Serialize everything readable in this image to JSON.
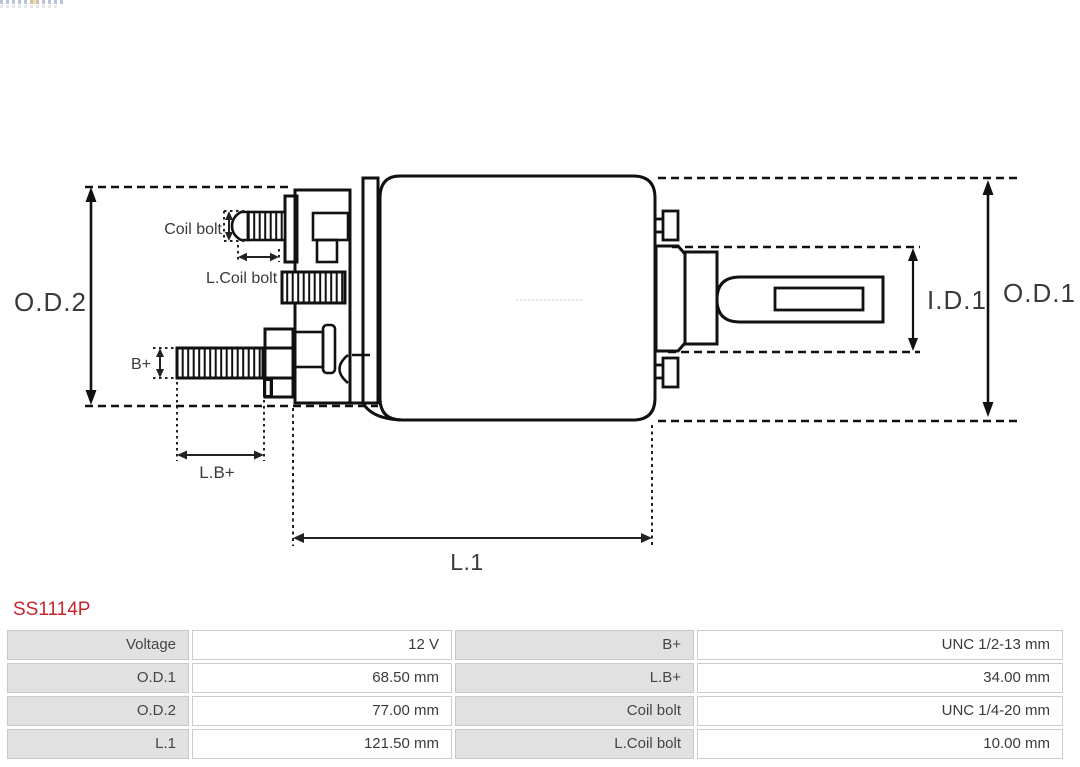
{
  "part_number": "SS1114P",
  "diagram": {
    "labels": {
      "od2": "O.D.2",
      "coil_bolt": "Coil bolt",
      "l_coil_bolt": "L.Coil bolt",
      "b_plus": "B+",
      "l_b_plus": "L.B+",
      "l1": "L.1",
      "id1": "I.D.1",
      "od1": "O.D.1"
    },
    "line_color": "#111111",
    "label_color": "#3a3a3a"
  },
  "spec_table": {
    "rows": [
      {
        "cells": [
          {
            "label": "Voltage",
            "value": "12 V"
          },
          {
            "label": "B+",
            "value": "UNC 1/2-13 mm"
          }
        ]
      },
      {
        "cells": [
          {
            "label": "O.D.1",
            "value": "68.50 mm"
          },
          {
            "label": "L.B+",
            "value": "34.00 mm"
          }
        ]
      },
      {
        "cells": [
          {
            "label": "O.D.2",
            "value": "77.00 mm"
          },
          {
            "label": "Coil bolt",
            "value": "UNC 1/4-20 mm"
          }
        ]
      },
      {
        "cells": [
          {
            "label": "L.1",
            "value": "121.50 mm"
          },
          {
            "label": "L.Coil bolt",
            "value": "10.00 mm"
          }
        ]
      }
    ]
  },
  "colors": {
    "part_number": "#c5262c",
    "table_label_bg": "#e1e1e1",
    "table_border": "#cccccc"
  }
}
